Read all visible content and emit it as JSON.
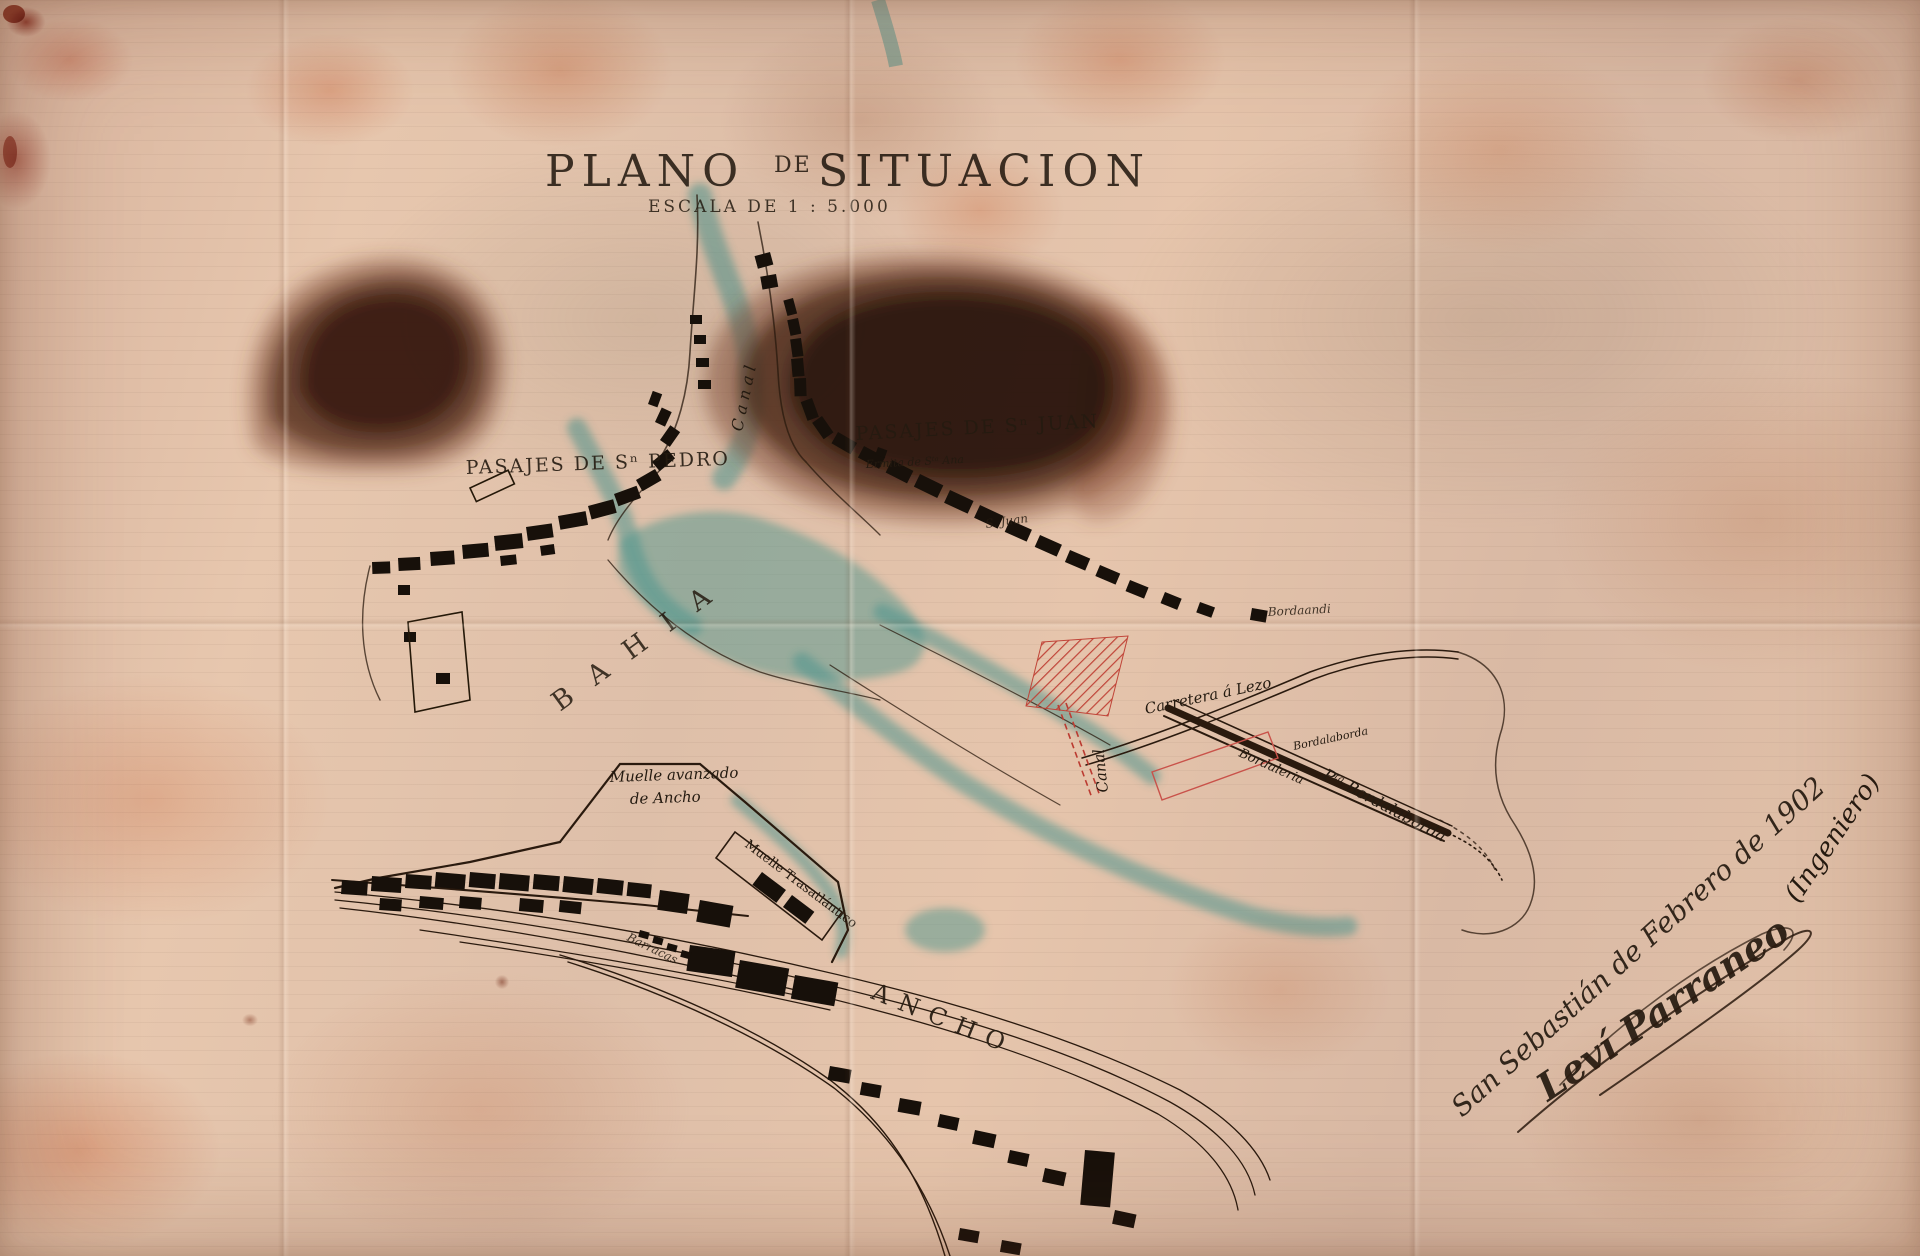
{
  "title_parts": [
    "PLANO",
    "DE",
    "SITUACION"
  ],
  "scale_label": "ESCALA DE 1 : 5.000",
  "labels": {
    "canal_top": "Canal",
    "bahia": "BAHIA",
    "pasajes_san_pedro": "PASAJES DE Sⁿ PEDRO",
    "pasajes_san_juan": "PASAJES DE Sⁿ JUAN",
    "ermita": "Ermita de Sᵗᵃ Ana",
    "san_juan": "S. Juan",
    "bordaandi": "Bordaandi",
    "carretera_lezo": "Carretera á Lezo",
    "canal_red": "Canal",
    "bordaleria": "Bordaleria",
    "bordalaborda": "Bordalaborda",
    "punta_bordalaborda": "Pᵗᵃ Bordalaborda",
    "muelle_avanzado_line1": "Muelle avanzado",
    "muelle_avanzado_line2": "de Ancho",
    "muelle_trasatlantico": "Muelle Trasatlántico",
    "barracas": "Barracas",
    "ancho": "ANCHO"
  },
  "inscription": {
    "dateline": "San Sebastián  de Febrero de 1902",
    "signature": "Leví Parraneo",
    "role": "(Ingeniero)"
  },
  "colors": {
    "paper": "#e4c2a9",
    "ink": "#26190f",
    "water": "#4f968e",
    "red_ink": "#bb3b31",
    "wash_dark": "#220e05",
    "wash_red": "#8a4a33"
  }
}
